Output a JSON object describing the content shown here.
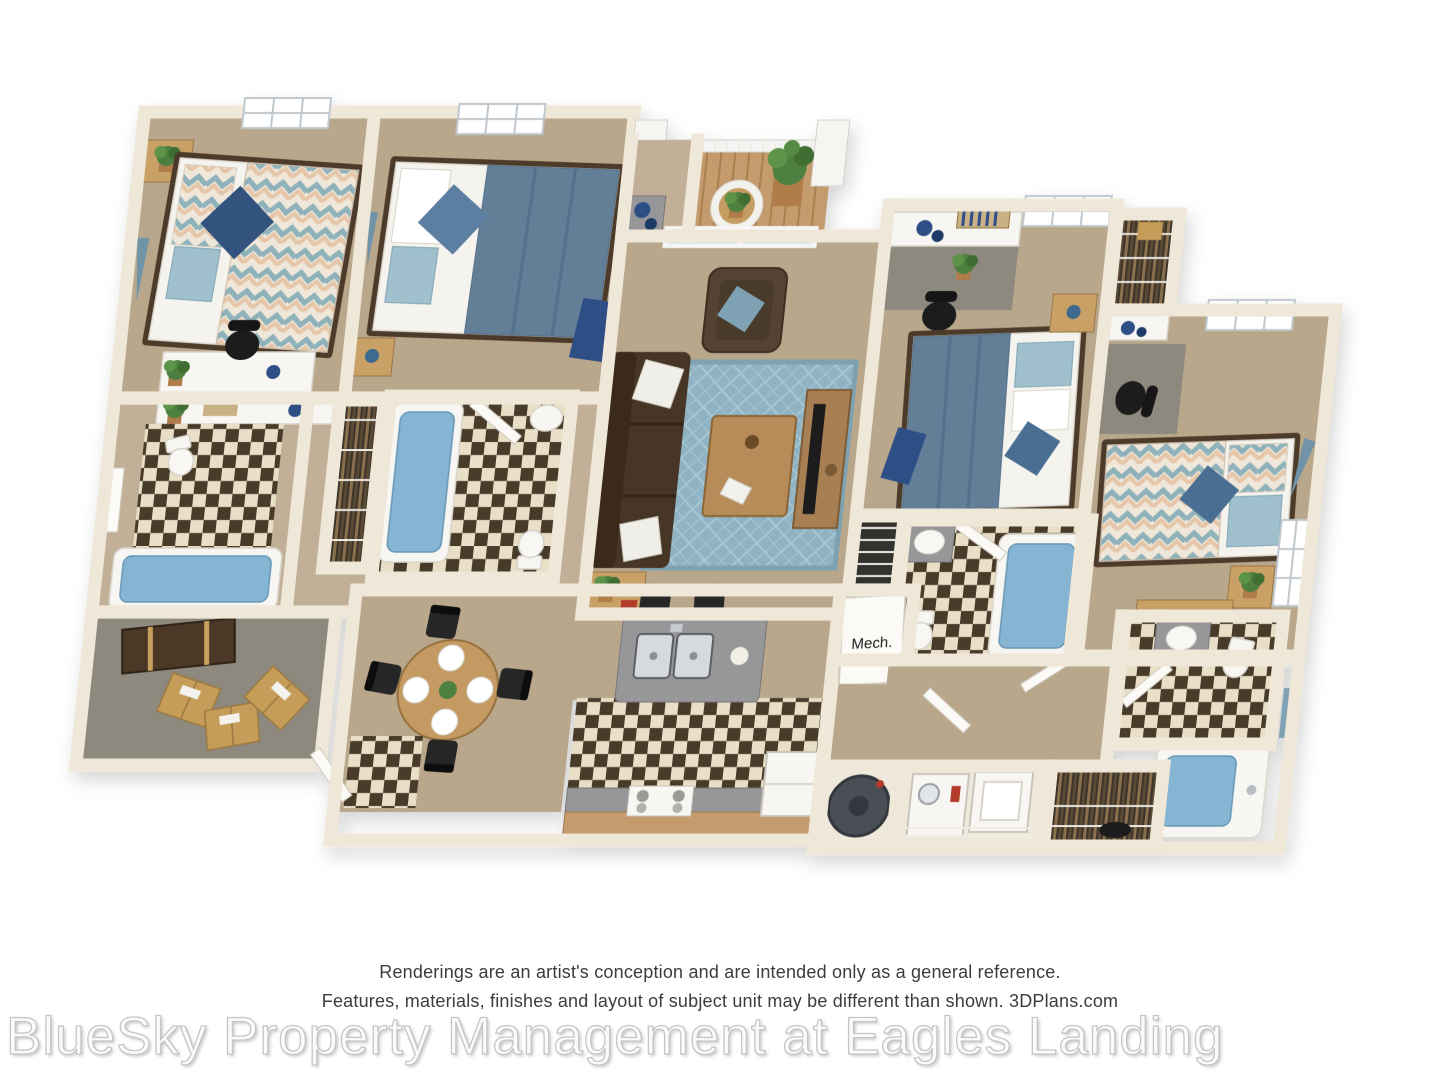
{
  "page": {
    "background": "#ffffff"
  },
  "plan": {
    "labels": {
      "mech": "Mech."
    },
    "colors": {
      "wall": "#efe8d9",
      "carpet": "#b9a78c",
      "gray_carpet": "#8e897e",
      "tile_light": "#e9dfc6",
      "tile_dark": "#483a2b",
      "deck_wood": "#c49b6c",
      "rug_blue": "#8fb3c2",
      "sofa_brown": "#473626",
      "armchair_brown": "#564331",
      "duvet_slate": "#637f97",
      "duvet_chevron_teal": "#8fb2ba",
      "duvet_chevron_blush": "#e6c6a8",
      "pillow_navy": "#33527d",
      "pillow_aqua": "#9fc0cc",
      "wood_light": "#c9a065",
      "granite": "#97979a",
      "tub_blue": "#85b5d2",
      "plant_green": "#4e8040",
      "appliance_white": "#f7f6f2",
      "water_heater": "#4a4f55"
    }
  },
  "footer": {
    "disclaimer_line1": "Renderings are an artist's conception and are intended only as a general reference.",
    "disclaimer_line2": "Features, materials, finishes and layout of subject unit may be different than shown. 3DPlans.com"
  },
  "watermark": {
    "text": "BlueSky Property Management at Eagles Landing"
  }
}
